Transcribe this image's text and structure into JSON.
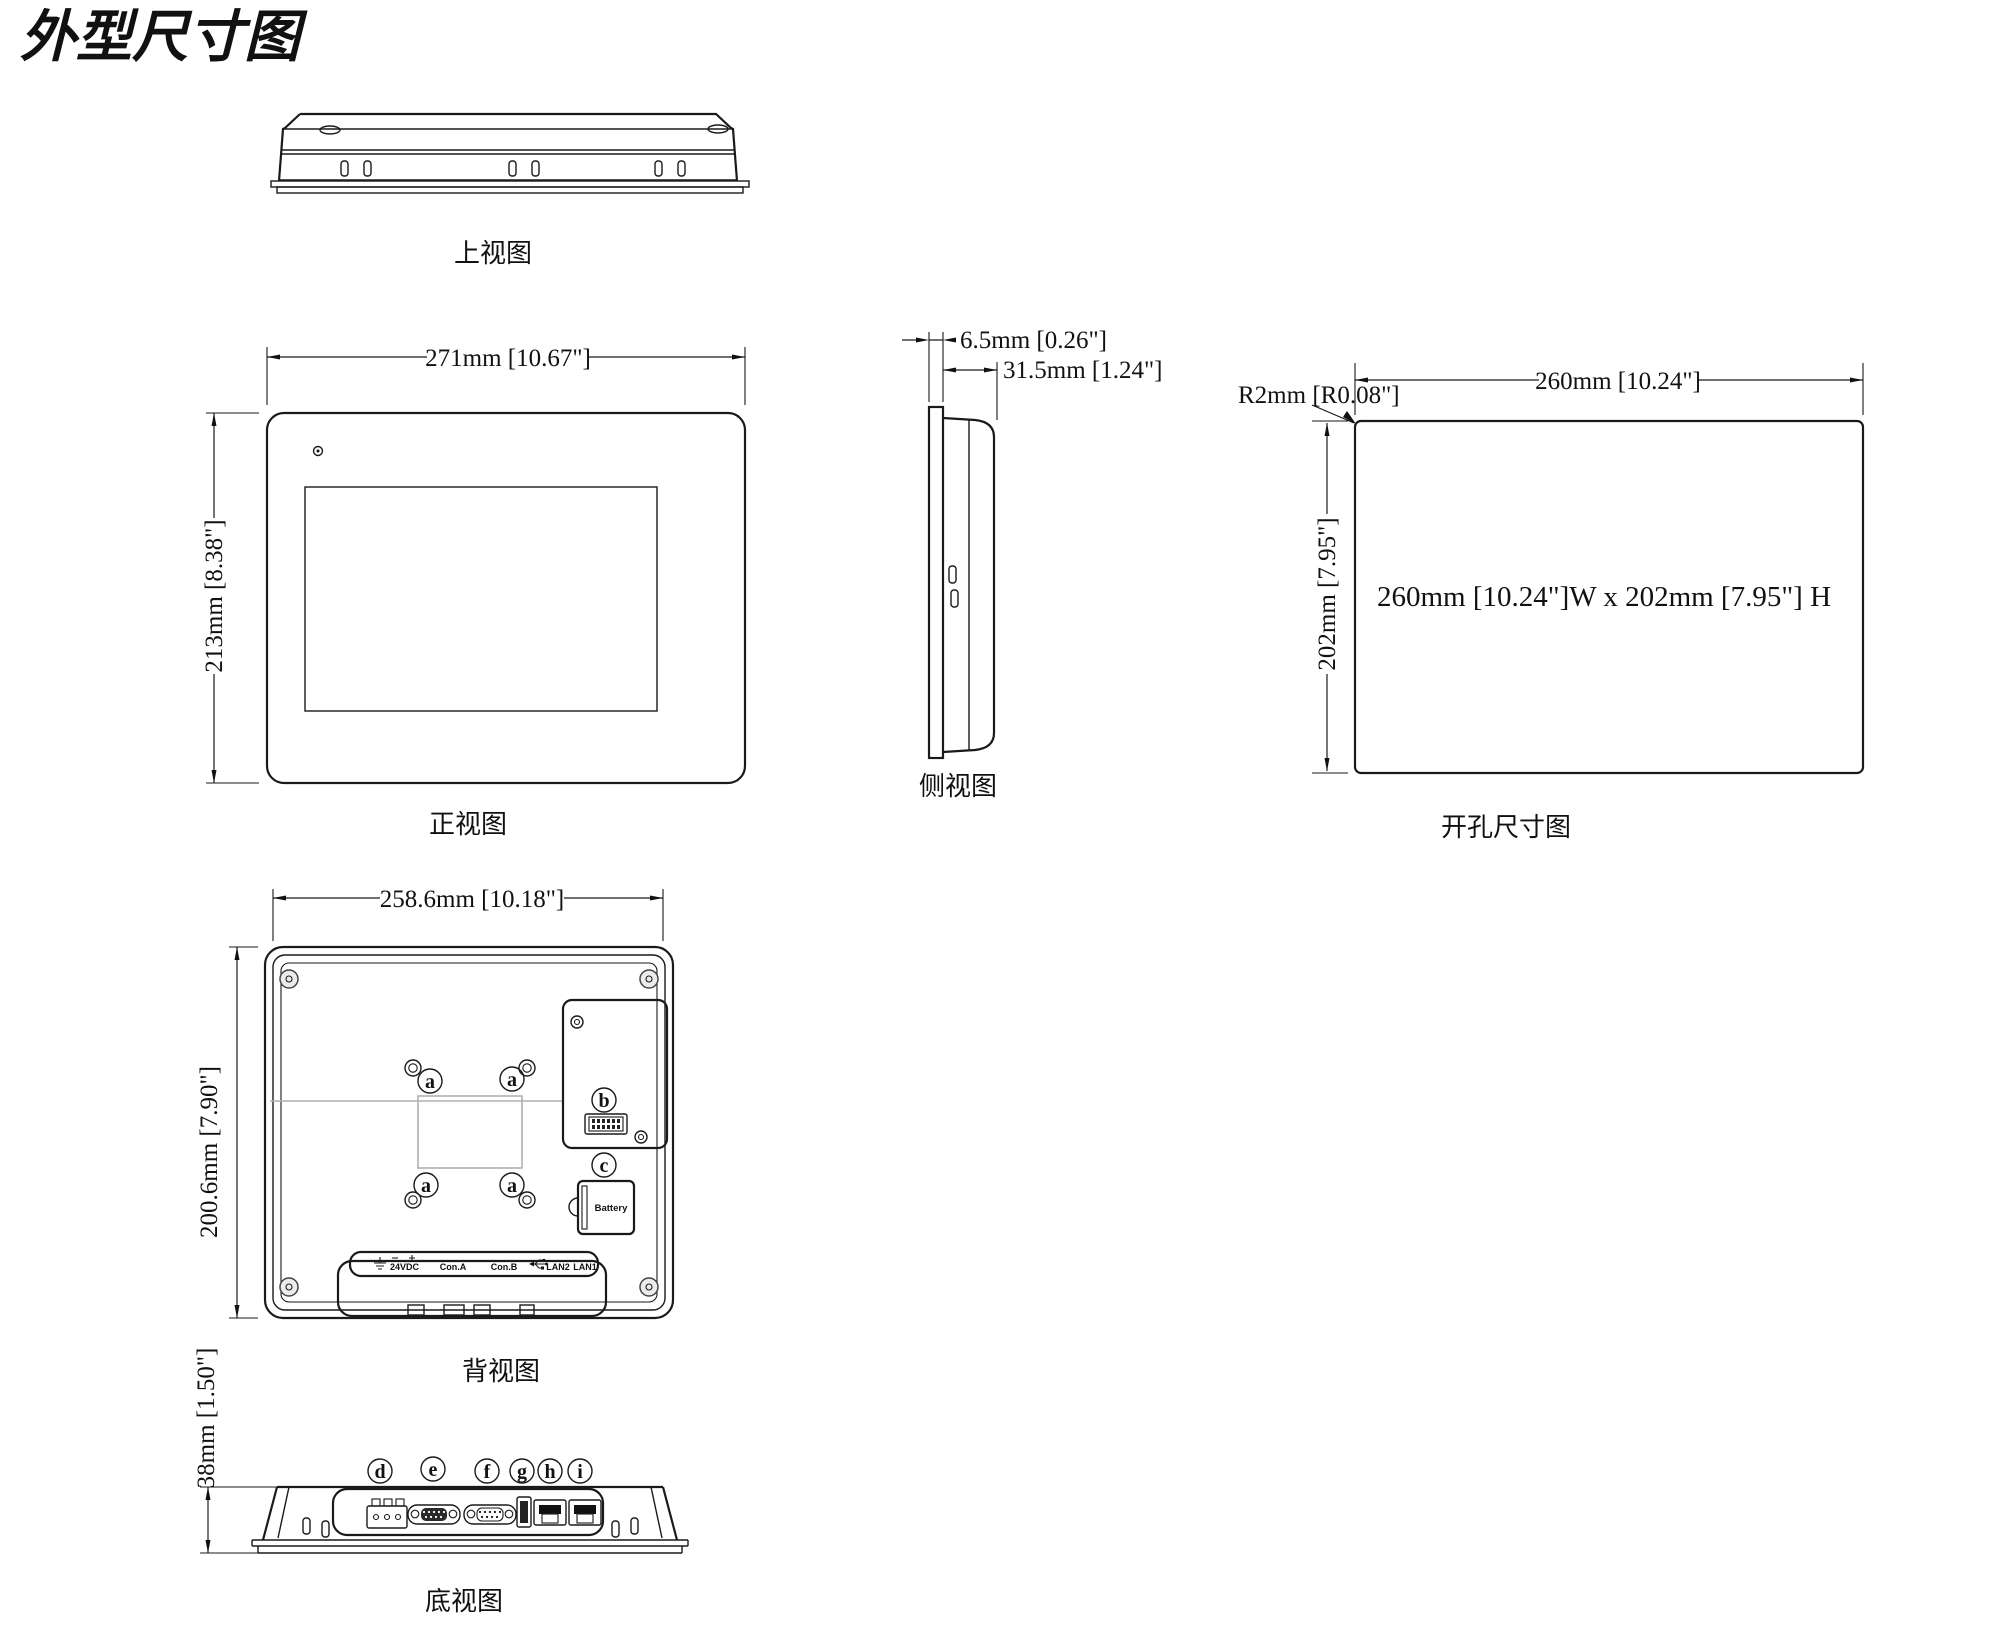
{
  "page": {
    "title": "外型尺寸图"
  },
  "views": {
    "top": {
      "label": "上视图"
    },
    "front": {
      "label": "正视图",
      "dim_width": "271mm [10.67\"]",
      "dim_height": "213mm [8.38\"]"
    },
    "side": {
      "label": "侧视图",
      "dim_front": "6.5mm [0.26\"]",
      "dim_depth": "31.5mm [1.24\"]"
    },
    "cutout": {
      "label": "开孔尺寸图",
      "dim_width": "260mm [10.24\"]",
      "dim_height": "202mm [7.95\"]",
      "corner_radius": "R2mm [R0.08\"]",
      "note": "260mm [10.24\"]W x 202mm [7.95\"] H"
    },
    "rear": {
      "label": "背视图",
      "dim_width": "258.6mm [10.18\"]",
      "dim_height": "200.6mm [7.90\"]",
      "callout_a": "a",
      "callout_b": "b",
      "callout_c": "c",
      "battery_label": "Battery",
      "port_labels": [
        "24VDC",
        "Con.A",
        "Con.B",
        "LAN2",
        "LAN1"
      ]
    },
    "bottom": {
      "label": "底视图",
      "dim_height": "38mm [1.50\"]",
      "callouts": [
        "d",
        "e",
        "f",
        "g",
        "h",
        "i"
      ]
    }
  }
}
